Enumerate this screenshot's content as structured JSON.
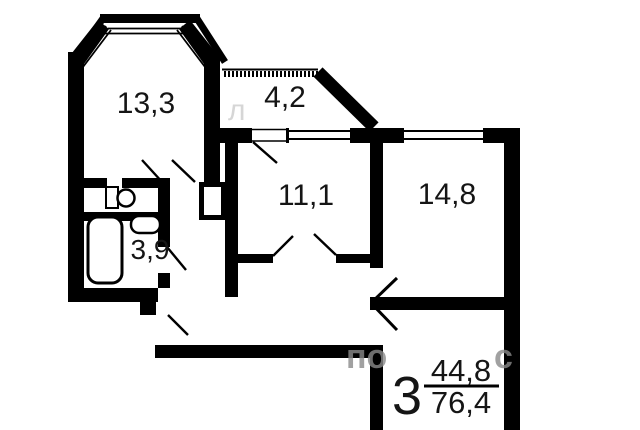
{
  "plan": {
    "title": "apartment floor plan",
    "rooms": [
      {
        "id": "room-13-3",
        "label": "13,3"
      },
      {
        "id": "loggia-4-2",
        "label": "4,2"
      },
      {
        "id": "room-11-1",
        "label": "11,1"
      },
      {
        "id": "room-14-8",
        "label": "14,8"
      },
      {
        "id": "bath-3-9",
        "label": "3,9"
      }
    ],
    "summary": {
      "rooms_count": "3",
      "living_area": "44,8",
      "total_area": "76,4"
    },
    "watermark": {
      "part1": "л",
      "part2": "по",
      "part3": "с"
    },
    "colors": {
      "wall": "#000000",
      "text": "#151515",
      "watermark": "#8a8a8a",
      "background": "#ffffff"
    }
  }
}
